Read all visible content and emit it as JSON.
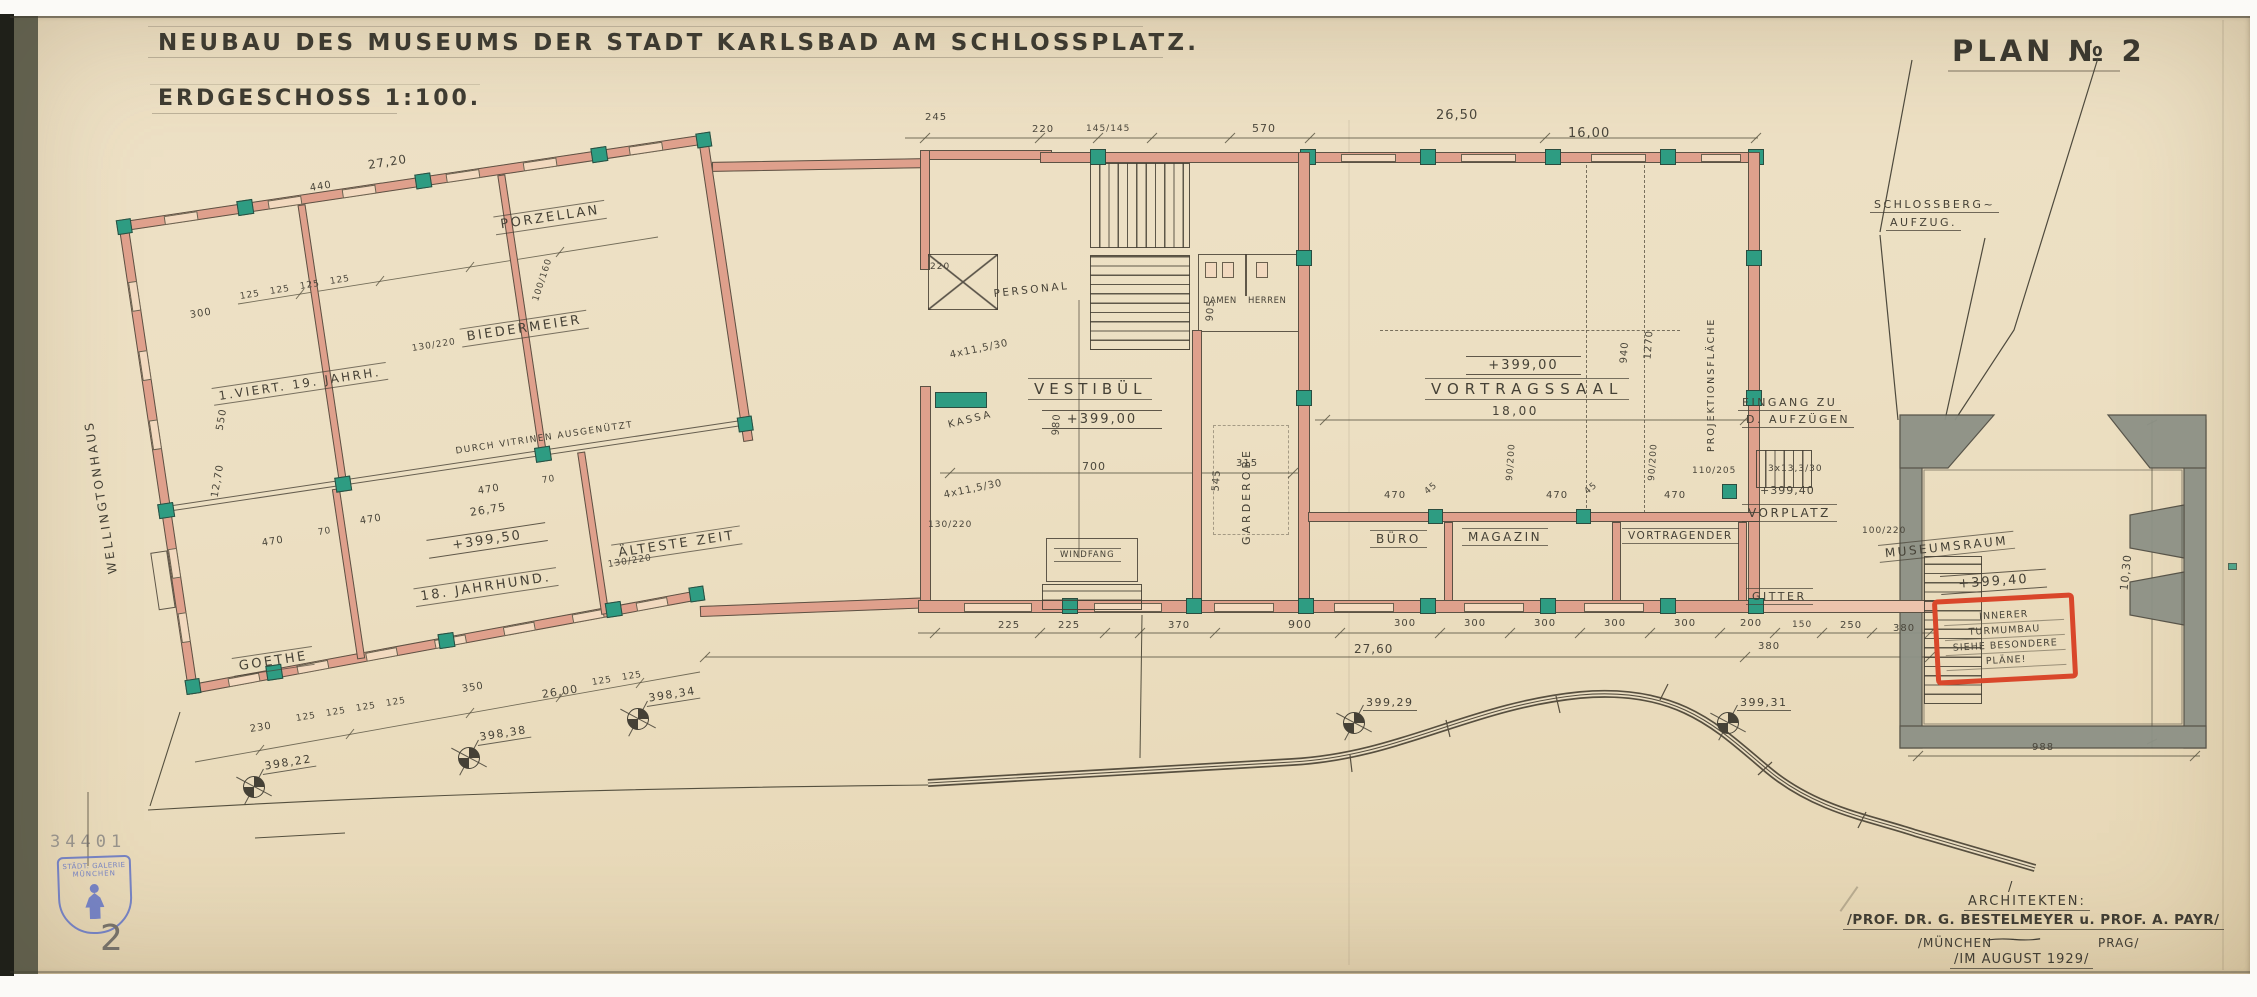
{
  "palette": {
    "paper": "#ecdfc2",
    "ink": "#454136",
    "wall_pink": "#dfa08c",
    "pier_teal": "#2e9c82",
    "tower_gray": "#8d9186",
    "note_red": "#d9472b",
    "stamp_blue": "#6273c3"
  },
  "header": {
    "title": "NEUBAU DES MUSEUMS DER STADT KARLSBAD AM SCHLOSSPLATZ.",
    "scale": "ERDGESCHOSS 1:100.",
    "plan_no": "PLAN № 2"
  },
  "rooms": {
    "wellingtonhaus": "WELLINGTONHAUS",
    "viert19": "1.VIERT. 19. JAHRH.",
    "biedermeier": "BIEDERMEIER",
    "porzellan": "PORZELLAN",
    "vitrinen": "DURCH VITRINEN AUSGENÜTZT",
    "goethe": "GOETHE",
    "jahrhund18": "18. JAHRHUND.",
    "aelteste": "ÄLTESTE ZEIT",
    "wing_level": "+399,50",
    "personal": "PERSONAL",
    "kassa": "KASSA",
    "vestibuel": "VESTIBÜL",
    "vestibuel_level": "+399,00",
    "windfang": "WINDFANG",
    "damen": "DAMEN",
    "herren": "HERREN",
    "garderobe": "GARDEROBE",
    "vortragssaal": "VORTRAGSSAAL",
    "saal_level": "+399,00",
    "saal_width": "18,00",
    "buero": "BÜRO",
    "magazin": "MAGAZIN",
    "vortragender": "VORTRAGENDER",
    "projektionsflaeche": "PROJEKTIONSFLÄCHE",
    "eingang1": "EINGANG ZU",
    "eingang2": "D. AUFZÜGEN",
    "vorplatz": "VORPLATZ",
    "gitter": "GITTER",
    "museumsraum": "MUSEUMSRAUM",
    "museum_level": "+399,40",
    "schloss1": "SCHLOSSBERG~",
    "schloss2": "AUFZUG."
  },
  "note_box": {
    "lines": [
      "INNERER",
      "TURMUMBAU",
      "SIEHE BESONDERE",
      "PLÄNE!"
    ]
  },
  "credits": {
    "slash": "/",
    "heading": "ARCHITEKTEN:",
    "line1": "/PROF. DR. G. BESTELMEYER u. PROF. A. PAYR/",
    "muenchen": "/MÜNCHEN",
    "wave": "~",
    "prag": "PRAG/",
    "date": "/IM AUGUST 1929/"
  },
  "stamp": {
    "number": "34401",
    "line1": "STÄDT. GALERIE",
    "line2": "MÜNCHEN",
    "page": "2"
  },
  "dims": [
    {
      "t": "27,20",
      "x": 368,
      "y": 158,
      "r": -9,
      "fs": 12
    },
    {
      "t": "440",
      "x": 310,
      "y": 183,
      "r": -9,
      "fs": 10
    },
    {
      "t": "125",
      "x": 240,
      "y": 292,
      "r": -9,
      "fs": 9
    },
    {
      "t": "125",
      "x": 270,
      "y": 287,
      "r": -9,
      "fs": 9
    },
    {
      "t": "125",
      "x": 300,
      "y": 282,
      "r": -9,
      "fs": 9
    },
    {
      "t": "125",
      "x": 330,
      "y": 277,
      "r": -9,
      "fs": 9
    },
    {
      "t": "300",
      "x": 190,
      "y": 310,
      "r": -9,
      "fs": 10
    },
    {
      "t": "130/220",
      "x": 412,
      "y": 344,
      "r": -9,
      "fs": 9
    },
    {
      "t": "100/160",
      "x": 536,
      "y": 296,
      "r": -72,
      "fs": 9
    },
    {
      "t": "550",
      "x": 220,
      "y": 425,
      "r": -80,
      "fs": 10
    },
    {
      "t": "12,70",
      "x": 215,
      "y": 492,
      "r": -80,
      "fs": 10
    },
    {
      "t": "470",
      "x": 262,
      "y": 538,
      "r": -9,
      "fs": 10
    },
    {
      "t": "70",
      "x": 318,
      "y": 528,
      "r": -9,
      "fs": 9
    },
    {
      "t": "470",
      "x": 360,
      "y": 516,
      "r": -9,
      "fs": 10
    },
    {
      "t": "470",
      "x": 478,
      "y": 486,
      "r": -9,
      "fs": 10
    },
    {
      "t": "70",
      "x": 542,
      "y": 476,
      "r": -9,
      "fs": 9
    },
    {
      "t": "26,75",
      "x": 470,
      "y": 506,
      "r": -9,
      "fs": 11
    },
    {
      "t": "130/220",
      "x": 608,
      "y": 560,
      "r": -9,
      "fs": 9
    },
    {
      "t": "350",
      "x": 462,
      "y": 684,
      "r": -9,
      "fs": 10
    },
    {
      "t": "26,00",
      "x": 542,
      "y": 688,
      "r": -9,
      "fs": 11
    },
    {
      "t": "230",
      "x": 250,
      "y": 724,
      "r": -9,
      "fs": 10
    },
    {
      "t": "125",
      "x": 296,
      "y": 714,
      "r": -9,
      "fs": 9
    },
    {
      "t": "125",
      "x": 326,
      "y": 709,
      "r": -9,
      "fs": 9
    },
    {
      "t": "125",
      "x": 356,
      "y": 704,
      "r": -9,
      "fs": 9
    },
    {
      "t": "125",
      "x": 386,
      "y": 699,
      "r": -9,
      "fs": 9
    },
    {
      "t": "125",
      "x": 592,
      "y": 678,
      "r": -9,
      "fs": 9
    },
    {
      "t": "125",
      "x": 622,
      "y": 673,
      "r": -9,
      "fs": 9
    },
    {
      "t": "245",
      "x": 925,
      "y": 112,
      "r": 0,
      "fs": 10
    },
    {
      "t": "220",
      "x": 1032,
      "y": 124,
      "r": 0,
      "fs": 10
    },
    {
      "t": "145/145",
      "x": 1086,
      "y": 124,
      "r": 0,
      "fs": 9
    },
    {
      "t": "570",
      "x": 1252,
      "y": 122,
      "r": 0,
      "fs": 11
    },
    {
      "t": "26,50",
      "x": 1436,
      "y": 108,
      "r": 0,
      "fs": 13
    },
    {
      "t": "16,00",
      "x": 1568,
      "y": 126,
      "r": 0,
      "fs": 13
    },
    {
      "t": "220",
      "x": 930,
      "y": 262,
      "r": 0,
      "fs": 9
    },
    {
      "t": "4x11,5/30",
      "x": 950,
      "y": 350,
      "r": -12,
      "fs": 10
    },
    {
      "t": "4x11,5/30",
      "x": 944,
      "y": 490,
      "r": -12,
      "fs": 10
    },
    {
      "t": "130/220",
      "x": 928,
      "y": 520,
      "r": 0,
      "fs": 9
    },
    {
      "t": "700",
      "x": 1082,
      "y": 460,
      "r": 0,
      "fs": 11
    },
    {
      "t": "980",
      "x": 1056,
      "y": 430,
      "r": -86,
      "fs": 10
    },
    {
      "t": "905",
      "x": 1210,
      "y": 316,
      "r": -86,
      "fs": 10
    },
    {
      "t": "545",
      "x": 1216,
      "y": 486,
      "r": -86,
      "fs": 10
    },
    {
      "t": "315",
      "x": 1236,
      "y": 458,
      "r": 0,
      "fs": 10
    },
    {
      "t": "470",
      "x": 1384,
      "y": 490,
      "r": 0,
      "fs": 10
    },
    {
      "t": "45",
      "x": 1426,
      "y": 488,
      "r": -40,
      "fs": 9
    },
    {
      "t": "470",
      "x": 1546,
      "y": 490,
      "r": 0,
      "fs": 10
    },
    {
      "t": "45",
      "x": 1586,
      "y": 488,
      "r": -40,
      "fs": 9
    },
    {
      "t": "470",
      "x": 1664,
      "y": 490,
      "r": 0,
      "fs": 10
    },
    {
      "t": "110/205",
      "x": 1692,
      "y": 466,
      "r": 0,
      "fs": 9
    },
    {
      "t": "3x13,3/30",
      "x": 1768,
      "y": 464,
      "r": 0,
      "fs": 9
    },
    {
      "t": "+399,40",
      "x": 1760,
      "y": 484,
      "r": 0,
      "fs": 11
    },
    {
      "t": "90/200",
      "x": 1510,
      "y": 476,
      "r": -86,
      "fs": 9
    },
    {
      "t": "90/200",
      "x": 1652,
      "y": 476,
      "r": -86,
      "fs": 9
    },
    {
      "t": "940",
      "x": 1624,
      "y": 358,
      "r": -86,
      "fs": 10
    },
    {
      "t": "1270",
      "x": 1648,
      "y": 354,
      "r": -86,
      "fs": 10
    },
    {
      "t": "225",
      "x": 998,
      "y": 620,
      "r": 0,
      "fs": 10
    },
    {
      "t": "225",
      "x": 1058,
      "y": 620,
      "r": 0,
      "fs": 10
    },
    {
      "t": "370",
      "x": 1168,
      "y": 620,
      "r": 0,
      "fs": 10
    },
    {
      "t": "900",
      "x": 1288,
      "y": 618,
      "r": 0,
      "fs": 11
    },
    {
      "t": "300",
      "x": 1394,
      "y": 618,
      "r": 0,
      "fs": 10
    },
    {
      "t": "300",
      "x": 1464,
      "y": 618,
      "r": 0,
      "fs": 10
    },
    {
      "t": "300",
      "x": 1534,
      "y": 618,
      "r": 0,
      "fs": 10
    },
    {
      "t": "300",
      "x": 1604,
      "y": 618,
      "r": 0,
      "fs": 10
    },
    {
      "t": "300",
      "x": 1674,
      "y": 618,
      "r": 0,
      "fs": 10
    },
    {
      "t": "200",
      "x": 1740,
      "y": 618,
      "r": 0,
      "fs": 10
    },
    {
      "t": "150",
      "x": 1792,
      "y": 620,
      "r": 0,
      "fs": 9
    },
    {
      "t": "250",
      "x": 1840,
      "y": 620,
      "r": 0,
      "fs": 10
    },
    {
      "t": "380",
      "x": 1893,
      "y": 623,
      "r": 0,
      "fs": 10
    },
    {
      "t": "27,60",
      "x": 1354,
      "y": 642,
      "r": 0,
      "fs": 12
    },
    {
      "t": "380",
      "x": 1758,
      "y": 641,
      "r": 0,
      "fs": 10
    },
    {
      "t": "100/220",
      "x": 1862,
      "y": 526,
      "r": 0,
      "fs": 9
    },
    {
      "t": "10,30",
      "x": 2124,
      "y": 584,
      "r": -84,
      "fs": 11
    },
    {
      "t": "988",
      "x": 2032,
      "y": 742,
      "r": 0,
      "fs": 10
    }
  ],
  "markers": [
    {
      "t": "398,22",
      "x": 243,
      "y": 776,
      "r": -9
    },
    {
      "t": "398,38",
      "x": 458,
      "y": 747,
      "r": -9
    },
    {
      "t": "398,34",
      "x": 627,
      "y": 708,
      "r": -9
    },
    {
      "t": "399,29",
      "x": 1343,
      "y": 712,
      "r": 0
    },
    {
      "t": "399,31",
      "x": 1717,
      "y": 712,
      "r": 0
    }
  ]
}
